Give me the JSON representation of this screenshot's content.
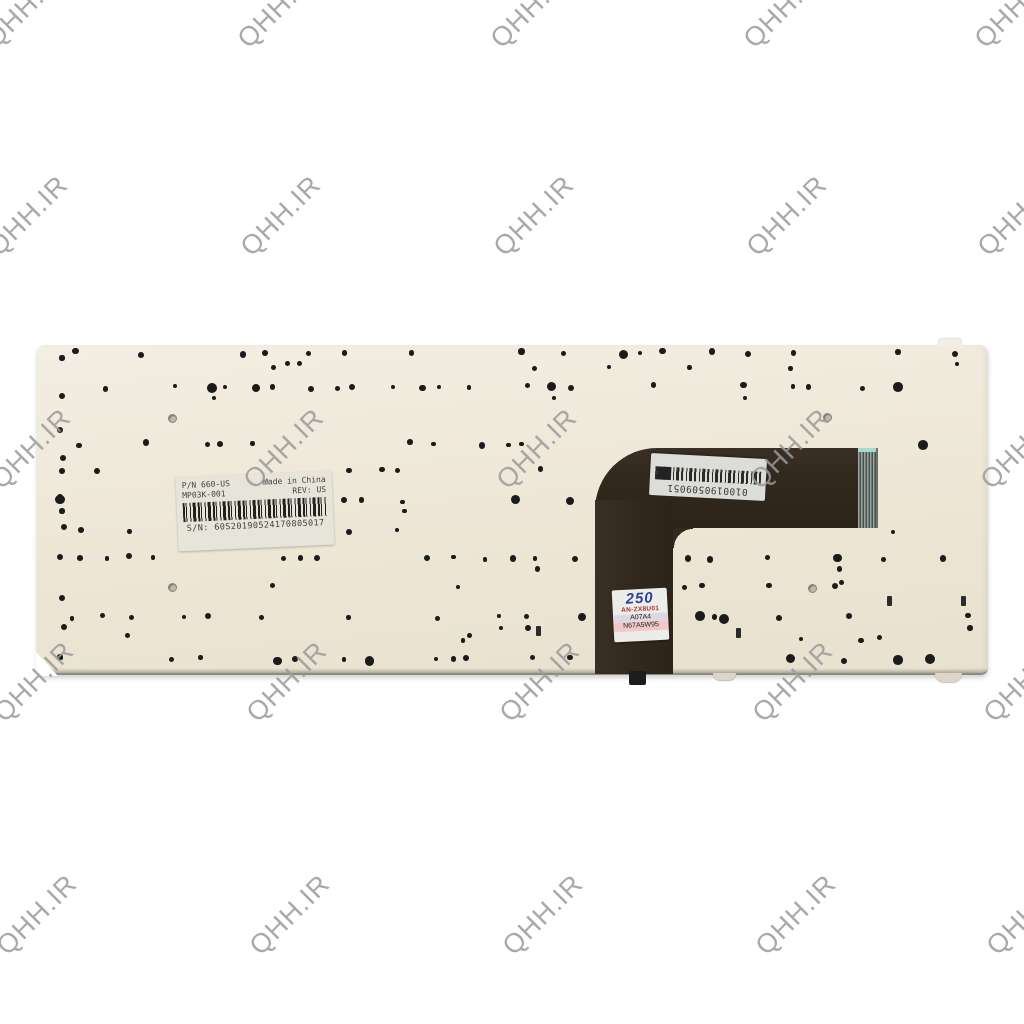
{
  "watermark": {
    "text": "QHH.IR"
  },
  "colors": {
    "watermark_gray": "#9b9b9b",
    "plate": "#ede6d5",
    "plate_light": "#f3eee3",
    "plate_dark": "#e8e1cf",
    "cable_brown": "#332a1f",
    "qc_blue": "#2a3f9e",
    "qc_red": "#b23030"
  },
  "label_sticker": {
    "pn": "P/N 660-US",
    "model": "MP03K-001",
    "made_in": "Made in China",
    "rev": "REV: US",
    "sn": "S/N: 60S20190524170805017"
  },
  "barcode_sticker": {
    "number": "0100190509051"
  },
  "qc_sticker": {
    "line1": "250",
    "line2": "AN-ZX8U01",
    "line3": "A07A4",
    "line4": "N67A5W95"
  }
}
